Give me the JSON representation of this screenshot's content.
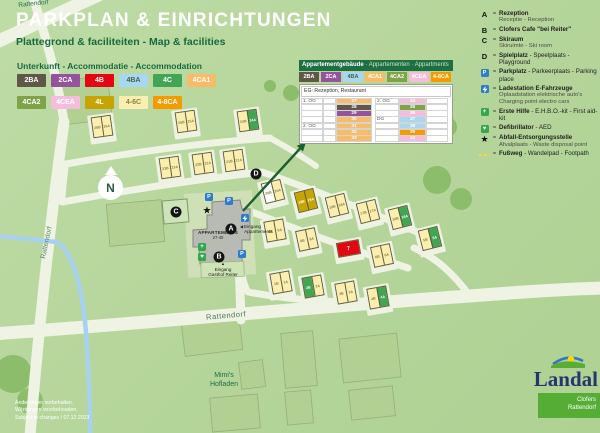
{
  "colors": {
    "background": "#b6d69c",
    "road": "#eef3e3",
    "stream": "#a7d1ef",
    "heading_green": "#18693f",
    "table_header_green": "#1d6e42",
    "marker_black": "#151515",
    "parking_blue": "#2e7ccc",
    "firstaid_green": "#33a84c"
  },
  "header": {
    "region_label": "Rattendorf",
    "title": "PARKPLAN & EINRICHTUNGEN",
    "subtitle": "Plattegrond & faciliteiten - Map & facilities"
  },
  "accommodation": {
    "heading": "Unterkunft - Accommodatie - Accommodation",
    "types": [
      {
        "code": "2BA",
        "bg": "#5f5748",
        "text": "#ffffff"
      },
      {
        "code": "2CA",
        "bg": "#94539d",
        "text": "#ffffff"
      },
      {
        "code": "4B",
        "bg": "#e30613",
        "text": "#ffffff"
      },
      {
        "code": "4BA",
        "bg": "#a9d7f2",
        "text": "#48663f"
      },
      {
        "code": "4C",
        "bg": "#41a553",
        "text": "#ffffff"
      },
      {
        "code": "4CA1",
        "bg": "#f8bb67",
        "text": "#ffffff"
      },
      {
        "code": "4CA2",
        "bg": "#7fa348",
        "text": "#ffffff"
      },
      {
        "code": "4CEA",
        "bg": "#f5bcdc",
        "text": "#ffffff"
      },
      {
        "code": "4L",
        "bg": "#c7a303",
        "text": "#ffffff"
      },
      {
        "code": "4-6C",
        "bg": "#fbeeb0",
        "text": "#85853f"
      },
      {
        "code": "4-8CA",
        "bg": "#f59b00",
        "text": "#ffffff"
      }
    ]
  },
  "apartment_table": {
    "title_bold": "Appartementgebäude",
    "title_rest": " · Appartementen · Appartments",
    "badges": [
      "2BA",
      "2CA",
      "4BA",
      "4CA1",
      "4CA2",
      "4CEA",
      "4-8CA"
    ],
    "ground_floor_row": "EG: Rezeption, Restaurant",
    "left_rows": [
      {
        "floor": "1. OG",
        "num": "27",
        "type": "4CA1"
      },
      {
        "floor": "",
        "num": "28",
        "type": "2BA"
      },
      {
        "floor": "",
        "num": "29",
        "type": "2CA"
      },
      {
        "floor": "",
        "num": "30",
        "type": "4CA1"
      },
      {
        "floor": "2. OG",
        "num": "31",
        "type": "4CA1"
      },
      {
        "floor": "",
        "num": "32",
        "type": "4CA1"
      },
      {
        "floor": "",
        "num": "33",
        "type": "4CA1"
      }
    ],
    "right_rows": [
      {
        "floor": "2. OG",
        "num": "34",
        "type": "4CEA"
      },
      {
        "floor": "",
        "num": "35",
        "type": "4CA2"
      },
      {
        "floor": "",
        "num": "36",
        "type": "4CEA"
      },
      {
        "floor": "DG",
        "num": "37",
        "type": "4BA"
      },
      {
        "floor": "",
        "num": "38",
        "type": "4BA"
      },
      {
        "floor": "",
        "num": "39",
        "type": "4-8CA"
      },
      {
        "floor": "",
        "num": "40",
        "type": "4CEA"
      }
    ]
  },
  "legend": {
    "separator": "=",
    "items": [
      {
        "icon": "letter",
        "glyph": "A",
        "bold": "Rezeption",
        "rest": "",
        "sub": [
          "Receptie - Reception"
        ]
      },
      {
        "icon": "letter",
        "glyph": "B",
        "bold": "Clofers Cafe \"bei Reiter\"",
        "rest": "",
        "sub": []
      },
      {
        "icon": "letter",
        "glyph": "C",
        "bold": "Skiraum",
        "rest": "",
        "sub": [
          "Skiruimte - Ski room"
        ]
      },
      {
        "icon": "letter",
        "glyph": "D",
        "bold": "Spielplatz",
        "rest": " - Speelplaats - Playground",
        "sub": []
      },
      {
        "icon": "parking",
        "glyph": "P",
        "bold": "Parkplatz",
        "rest": " - Parkeerplaats - Parking place",
        "sub": []
      },
      {
        "icon": "charging",
        "glyph": "",
        "bold": "Ladestation E-Fahrzeuge",
        "rest": "",
        "sub": [
          "Oplaadstation elektrische auto's",
          "Charging point electro cars"
        ]
      },
      {
        "icon": "firstaid",
        "glyph": "+",
        "bold": "Erste Hilfe",
        "rest": " - E.H.B.O.-kit - First aid-kit",
        "sub": []
      },
      {
        "icon": "aed",
        "glyph": "♥",
        "bold": "Defibrillator",
        "rest": " - AED",
        "sub": []
      },
      {
        "icon": "star",
        "glyph": "★",
        "bold": "Abfall-Entsorgungsstelle",
        "rest": "",
        "sub": [
          "Afvalplaats - Waste disposal point"
        ]
      },
      {
        "icon": "footpath",
        "glyph": "",
        "bold": "Fußweg",
        "rest": " - Wandelpad - Footpath",
        "sub": []
      }
    ]
  },
  "map": {
    "compass": "N",
    "building_label": "APPARTEMENTS",
    "building_range": "27-40",
    "entrance_apartments_arrow": "◀",
    "entrance_apartments": "Eingang\nAppartements",
    "entrance_gasthof_arrow": "▲",
    "entrance_gasthof": "Eingang\nGasthof Reiter",
    "street_left": "Rattendorf",
    "street_bottom": "Rattendorf",
    "poi_mimis": "Mimi's\nHofladen",
    "markers": [
      {
        "name": "reception-a",
        "kind": "circle",
        "label": "A",
        "x": 231,
        "y": 229
      },
      {
        "name": "cafe-b",
        "kind": "circle",
        "label": "B",
        "x": 219,
        "y": 257
      },
      {
        "name": "skiroom-c",
        "kind": "circle",
        "label": "C",
        "x": 176,
        "y": 212
      },
      {
        "name": "playground-d",
        "kind": "circle",
        "label": "D",
        "x": 256,
        "y": 174
      },
      {
        "name": "parking-1",
        "kind": "parking",
        "label": "P",
        "x": 209,
        "y": 197
      },
      {
        "name": "parking-2",
        "kind": "parking",
        "label": "P",
        "x": 229,
        "y": 201
      },
      {
        "name": "parking-3",
        "kind": "parking",
        "label": "P",
        "x": 242,
        "y": 254
      },
      {
        "name": "ev-charging",
        "kind": "charging",
        "label": "",
        "x": 245,
        "y": 218
      },
      {
        "name": "first-aid",
        "kind": "firstaid",
        "label": "+",
        "x": 202,
        "y": 247
      },
      {
        "name": "defibrillator",
        "kind": "aed",
        "label": "♥",
        "x": 202,
        "y": 257
      },
      {
        "name": "waste-disposal",
        "kind": "star",
        "label": "★",
        "x": 207,
        "y": 211
      }
    ],
    "buildings": [
      {
        "x": 92,
        "y": 116,
        "rot": -8,
        "units": [
          {
            "l": "26B",
            "t": "4-6C"
          },
          {
            "l": "26A",
            "t": "4-6C"
          }
        ]
      },
      {
        "x": 176,
        "y": 111,
        "rot": -8,
        "units": [
          {
            "l": "25B",
            "t": "4-6C"
          },
          {
            "l": "25A",
            "t": "4-6C"
          }
        ]
      },
      {
        "x": 238,
        "y": 110,
        "rot": -8,
        "units": [
          {
            "l": "24B",
            "t": "4-6C"
          },
          {
            "l": "24A",
            "t": "4C"
          }
        ]
      },
      {
        "x": 160,
        "y": 157,
        "rot": -8,
        "units": [
          {
            "l": "23B",
            "t": "4-6C"
          },
          {
            "l": "23A",
            "t": "4-6C"
          }
        ]
      },
      {
        "x": 193,
        "y": 153,
        "rot": -8,
        "units": [
          {
            "l": "22B",
            "t": "4-6C"
          },
          {
            "l": "22A",
            "t": "4-6C"
          }
        ]
      },
      {
        "x": 224,
        "y": 150,
        "rot": -8,
        "units": [
          {
            "l": "21B",
            "t": "4-6C"
          },
          {
            "l": "21A",
            "t": "4-6C"
          }
        ]
      },
      {
        "x": 263,
        "y": 181,
        "rot": -14,
        "units": [
          {
            "l": "20B",
            "t": "white"
          },
          {
            "l": "20A",
            "t": "4-6C"
          }
        ]
      },
      {
        "x": 296,
        "y": 190,
        "rot": -14,
        "units": [
          {
            "l": "19B",
            "t": "4L"
          },
          {
            "l": "19A",
            "t": "4L"
          }
        ]
      },
      {
        "x": 327,
        "y": 195,
        "rot": -14,
        "units": [
          {
            "l": "18B",
            "t": "4-6C"
          },
          {
            "l": "18A",
            "t": "4-6C"
          }
        ]
      },
      {
        "x": 358,
        "y": 201,
        "rot": -14,
        "units": [
          {
            "l": "17B",
            "t": "4-6C"
          },
          {
            "l": "17A",
            "t": "4-6C"
          }
        ]
      },
      {
        "x": 390,
        "y": 207,
        "rot": -14,
        "units": [
          {
            "l": "16B",
            "t": "4-6C"
          },
          {
            "l": "16A",
            "t": "4C"
          }
        ]
      },
      {
        "x": 265,
        "y": 220,
        "rot": -10,
        "units": [
          {
            "l": "9B",
            "t": "4-6C"
          },
          {
            "l": "9A",
            "t": "4-6C"
          }
        ]
      },
      {
        "x": 297,
        "y": 229,
        "rot": -12,
        "units": [
          {
            "l": "8B",
            "t": "4-6C"
          },
          {
            "l": "8A",
            "t": "4-6C"
          }
        ]
      },
      {
        "x": 337,
        "y": 241,
        "rot": -10,
        "single": true,
        "units": [
          {
            "l": "7",
            "t": "4B"
          }
        ]
      },
      {
        "x": 372,
        "y": 245,
        "rot": -12,
        "units": [
          {
            "l": "6B",
            "t": "4-6C"
          },
          {
            "l": "6A",
            "t": "4-6C"
          }
        ]
      },
      {
        "x": 420,
        "y": 228,
        "rot": -14,
        "units": [
          {
            "l": "5B",
            "t": "4-6C"
          },
          {
            "l": "5A",
            "t": "4C"
          }
        ]
      },
      {
        "x": 271,
        "y": 272,
        "rot": -10,
        "units": [
          {
            "l": "1B",
            "t": "4-6C"
          },
          {
            "l": "1A",
            "t": "4-6C"
          }
        ]
      },
      {
        "x": 303,
        "y": 276,
        "rot": -10,
        "units": [
          {
            "l": "2B",
            "t": "4C"
          },
          {
            "l": "2A",
            "t": "4-6C"
          }
        ]
      },
      {
        "x": 336,
        "y": 282,
        "rot": -10,
        "units": [
          {
            "l": "3B",
            "t": "4-6C"
          },
          {
            "l": "3A",
            "t": "4-6C"
          }
        ]
      },
      {
        "x": 368,
        "y": 287,
        "rot": -10,
        "units": [
          {
            "l": "4B",
            "t": "4-6C"
          },
          {
            "l": "4A",
            "t": "4C"
          }
        ]
      }
    ]
  },
  "footer": {
    "line1": "Änderungen vorbehalten.",
    "line2": "Wijzigingen voorbehouden.",
    "line3": "Subject to changes / 07.12.2023"
  },
  "logo": {
    "brand": "Landal",
    "location_line1": "Clofers",
    "location_line2": "Rattendorf",
    "brand_color": "#27356e",
    "green": "#56ad35"
  }
}
